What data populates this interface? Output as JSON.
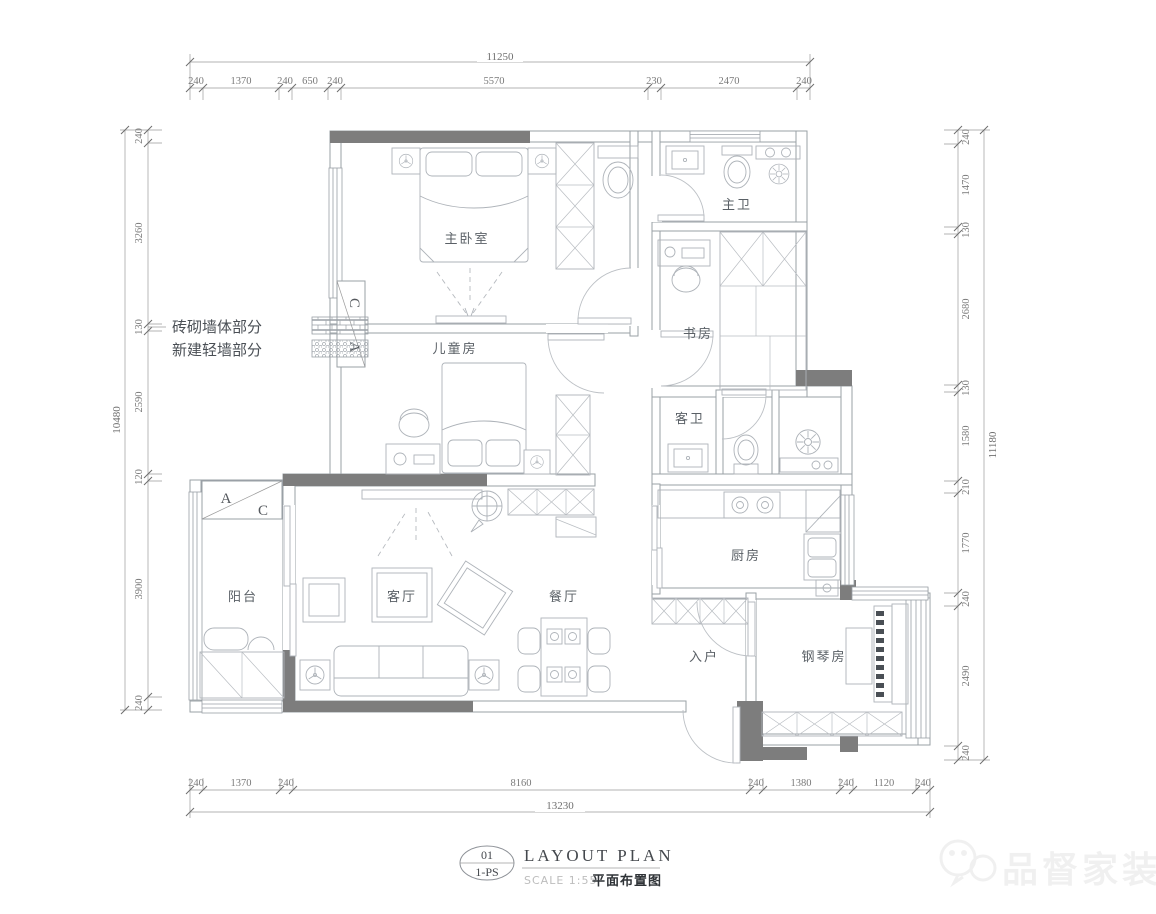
{
  "title_block": {
    "number": "01",
    "sheet": "1-PS",
    "title": "LAYOUT  PLAN",
    "scale": "SCALE 1:55",
    "subtitle": "平面布置图"
  },
  "legend": {
    "brick_label": "砖砌墙体部分",
    "light_label": "新建轻墙部分"
  },
  "rooms": {
    "master_bedroom": "主卧室",
    "master_bath": "主卫",
    "study": "书房",
    "kids_room": "儿童房",
    "guest_bath": "客卫",
    "kitchen": "厨房",
    "living": "客厅",
    "dining": "餐厅",
    "balcony": "阳台",
    "entry": "入户",
    "piano": "钢琴房"
  },
  "markers": {
    "a": "A",
    "c": "C"
  },
  "dimensions": {
    "top": {
      "total": "11250",
      "segments": [
        "240",
        "1370",
        "240",
        "650",
        "240",
        "5570",
        "230",
        "2470",
        "240"
      ]
    },
    "bottom": {
      "total": "13230",
      "segments": [
        "240",
        "1370",
        "240",
        "8160",
        "240",
        "1380",
        "240",
        "1120",
        "240"
      ]
    },
    "left": {
      "total": "10480",
      "segments": [
        "240",
        "3260",
        "130",
        "2590",
        "120",
        "3900",
        "240"
      ]
    },
    "right": {
      "total": "11180",
      "segments": [
        "240",
        "1470",
        "130",
        "2680",
        "130",
        "1580",
        "210",
        "1770",
        "240",
        "2490",
        "240"
      ]
    }
  },
  "watermark": {
    "text": "品督家装"
  },
  "colors": {
    "wall_dark": "#7d7d7d",
    "line": "#9aa0a6",
    "dim_text": "#7a7a7a"
  }
}
